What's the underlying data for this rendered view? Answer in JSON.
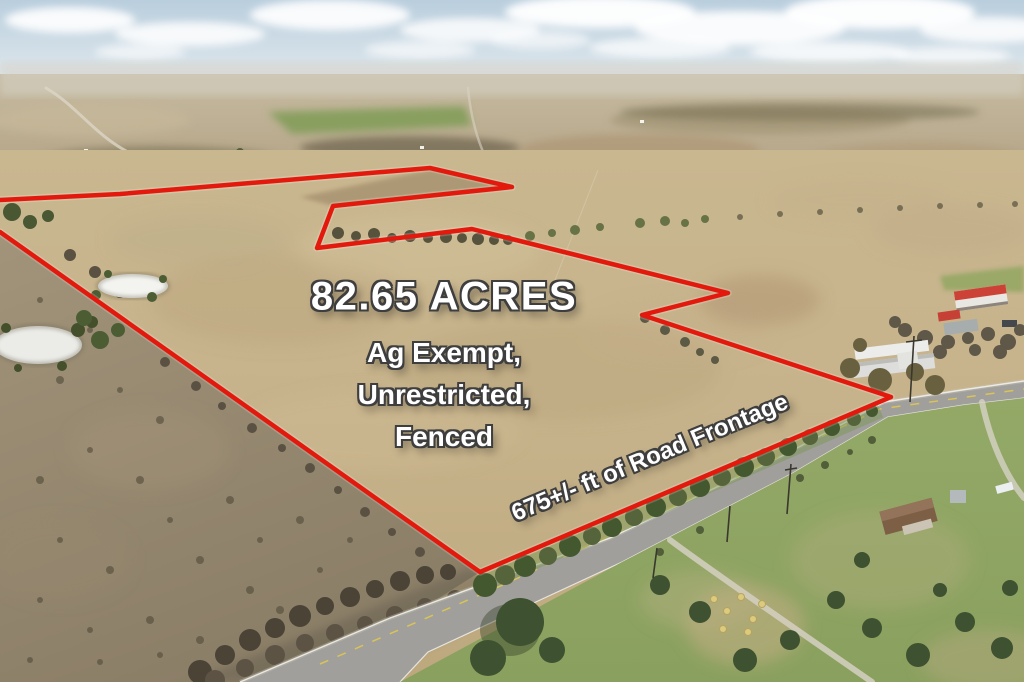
{
  "listing": {
    "acreage": "82.65 ACRES",
    "features": [
      "Ag Exempt,",
      "Unrestricted,",
      "Fenced"
    ],
    "road_frontage": "675+/-  ft of Road Frontage"
  },
  "colors": {
    "boundary_red": "#e4190e",
    "overlay_text": "#ffffff",
    "text_outline": "#3e3e3e"
  }
}
